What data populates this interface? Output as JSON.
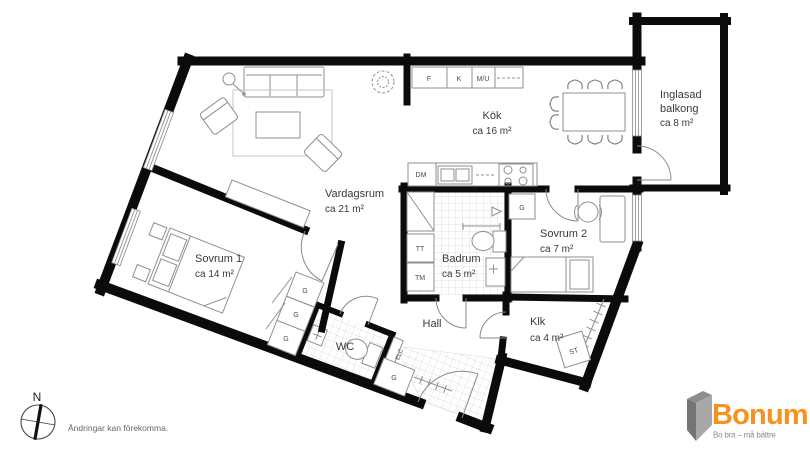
{
  "page": {
    "background": "#ffffff",
    "wall_color": "#0b0b0b",
    "furniture_color": "#8f8f8f"
  },
  "rooms": {
    "vardagsrum": {
      "name": "Vardagsrum",
      "area": "ca 21 m²"
    },
    "sovrum1": {
      "name": "Sovrum 1",
      "area": "ca 14 m²"
    },
    "sovrum2": {
      "name": "Sovrum 2",
      "area": "ca 7 m²"
    },
    "kok": {
      "name": "Kök",
      "area": "ca 16 m²"
    },
    "badrum": {
      "name": "Badrum",
      "area": "ca 5 m²"
    },
    "hall": {
      "name": "Hall"
    },
    "wc": {
      "name": "WC"
    },
    "klk": {
      "name": "Klk",
      "area": "ca 4 m²"
    },
    "balkong": {
      "line1": "Inglasad",
      "line2": "balkong",
      "area": "ca 8 m²"
    }
  },
  "fixtures": {
    "f": "F",
    "k": "K",
    "mu": "M/U",
    "dm": "DM",
    "g": "G",
    "tt": "TT",
    "tm": "TM",
    "elc": "ELC",
    "st": "ST"
  },
  "compass": {
    "north": "N"
  },
  "disclaimer": "Ändringar kan förekomma.",
  "branding": {
    "name": "Bonum",
    "tagline": "Bo bra – må bättre",
    "brand_color": "#F6921E",
    "icon_color": "#8d8d8d"
  }
}
